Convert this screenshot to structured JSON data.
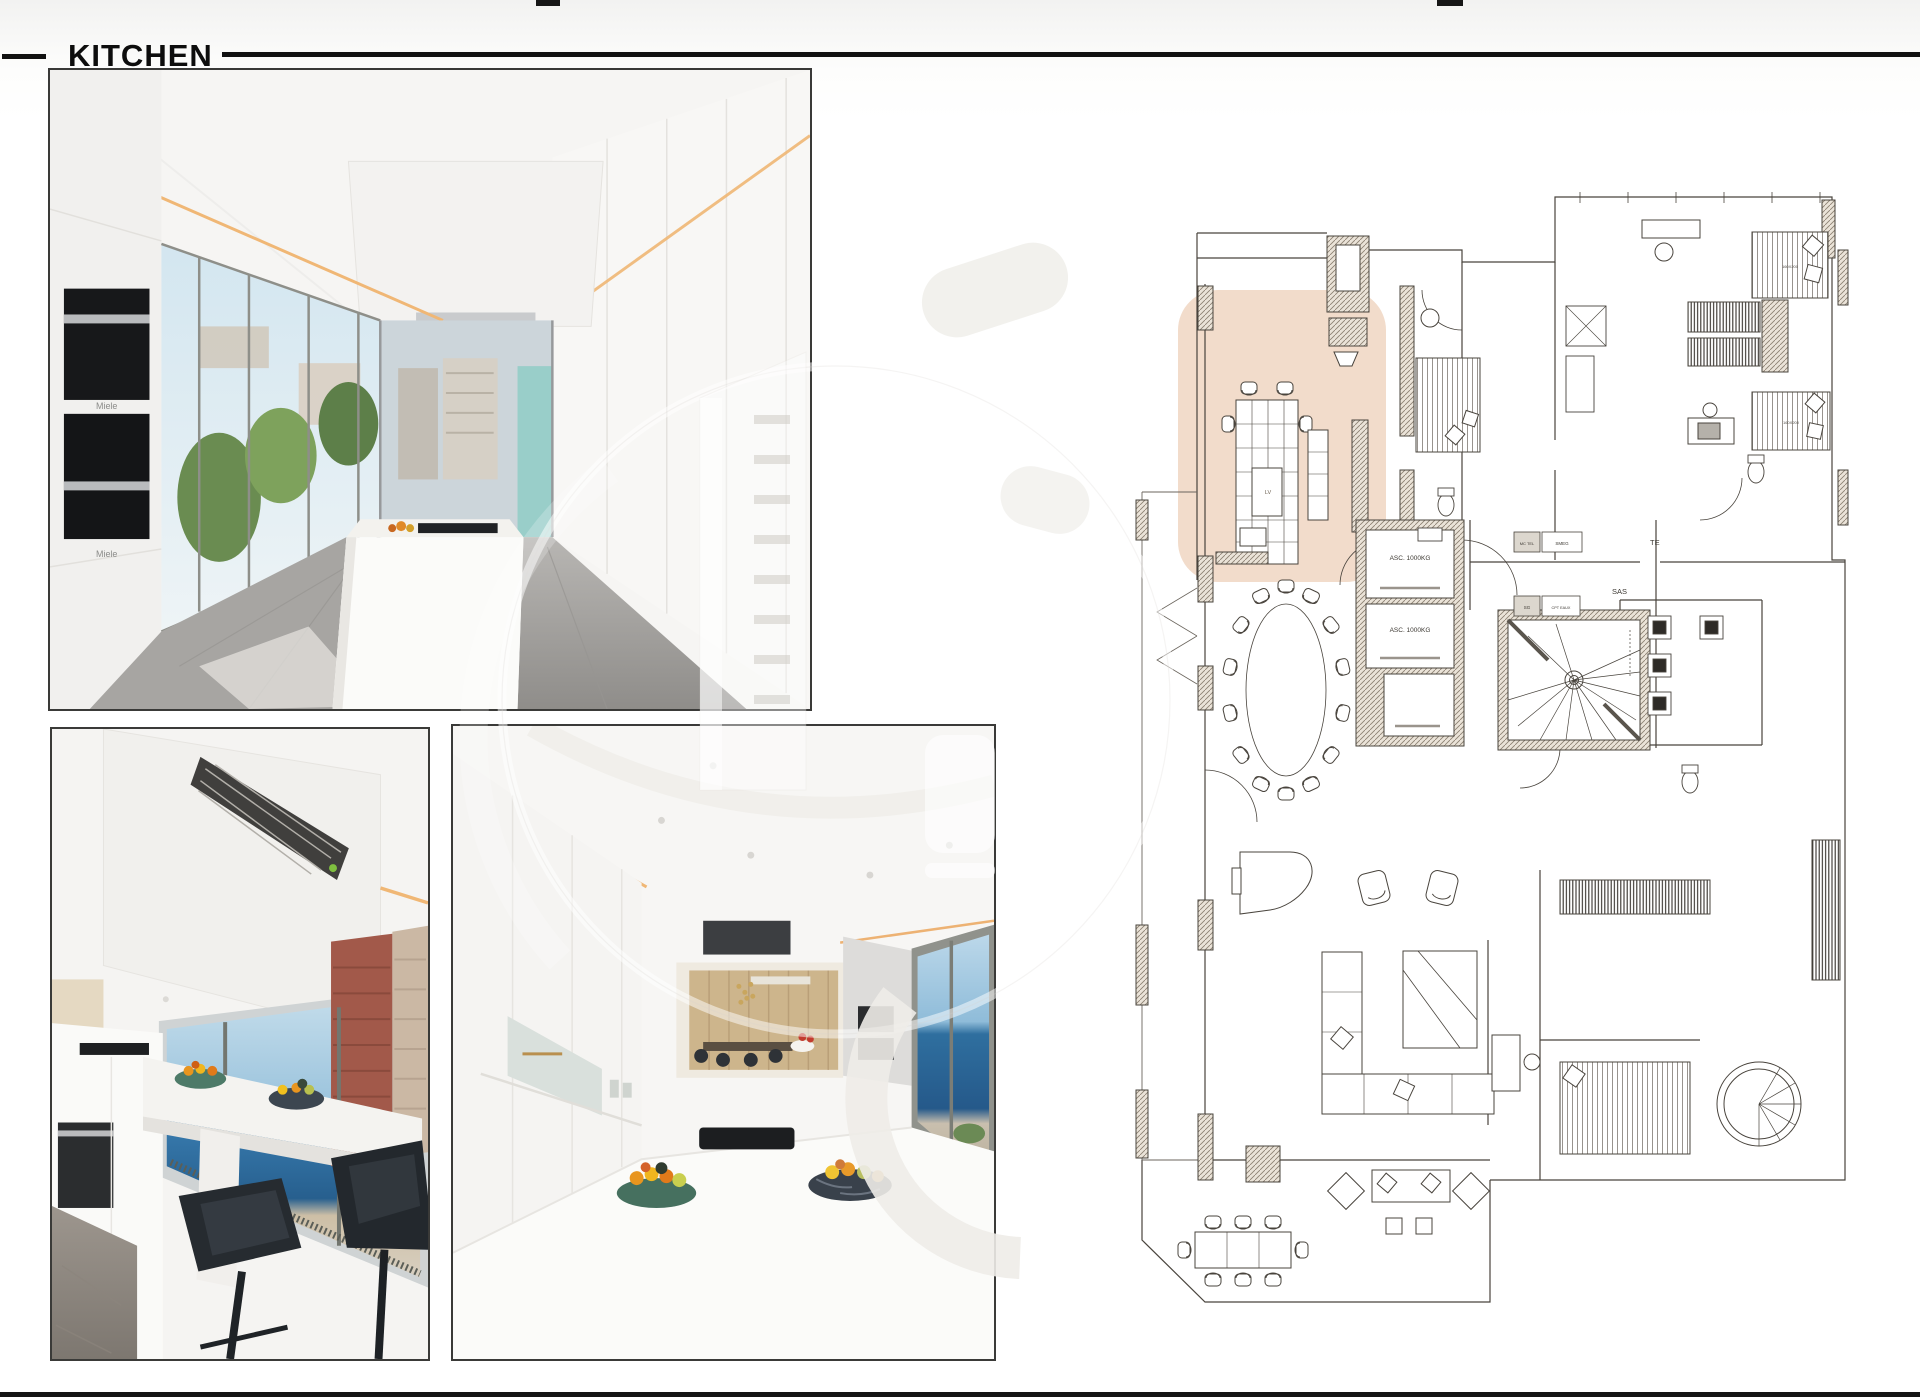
{
  "header": {
    "title": "KITCHEN"
  },
  "photo1": {
    "appliance_brand_top": "Miele",
    "appliance_brand_bottom": "Miele"
  },
  "floor_plan": {
    "labels": {
      "elevator_1": "ASC. 1000KG",
      "elevator_2": "ASC. 1000KG",
      "vestibule": "SAS",
      "dishwasher": "LV",
      "tech_1": "MC TEL",
      "tech_2": "SMEG",
      "tech_3": "SG",
      "tech_4": "CPT EAUX",
      "terrace_abbr": "TE",
      "bed_size_1": "160X200",
      "bed_size_2": "160X200"
    },
    "colors": {
      "highlight": "#f2dccb",
      "lines": "#49443d"
    }
  }
}
